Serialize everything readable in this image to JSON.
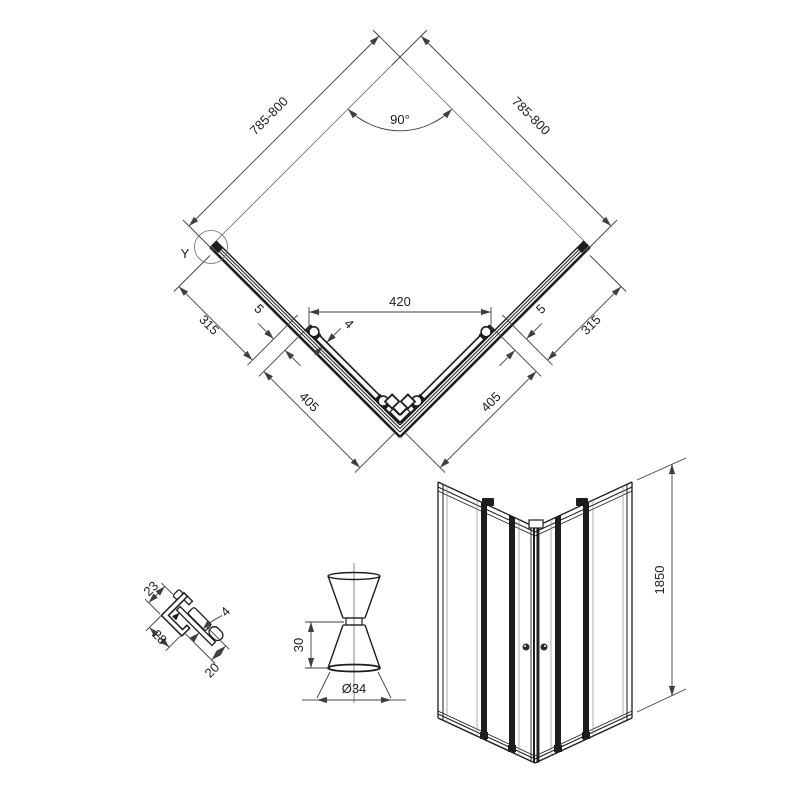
{
  "top_view": {
    "side_left": "785-800",
    "side_right": "785-800",
    "angle": "90°",
    "opening": "420",
    "glass": "4",
    "gap_left": "5",
    "gap_right": "5",
    "panel_left": "315",
    "panel_right": "315",
    "door_left": "405",
    "door_right": "405",
    "detail": "Y"
  },
  "detail_view": {
    "top": "23",
    "glass": "4",
    "side": "28",
    "bottom": "20"
  },
  "knob_view": {
    "height": "30",
    "diameter": "Ø34"
  },
  "front_view": {
    "height": "1850"
  },
  "colors": {
    "object_line": "#1d1d1d",
    "dimension_line": "#3f3f3f",
    "background": "#ffffff"
  }
}
